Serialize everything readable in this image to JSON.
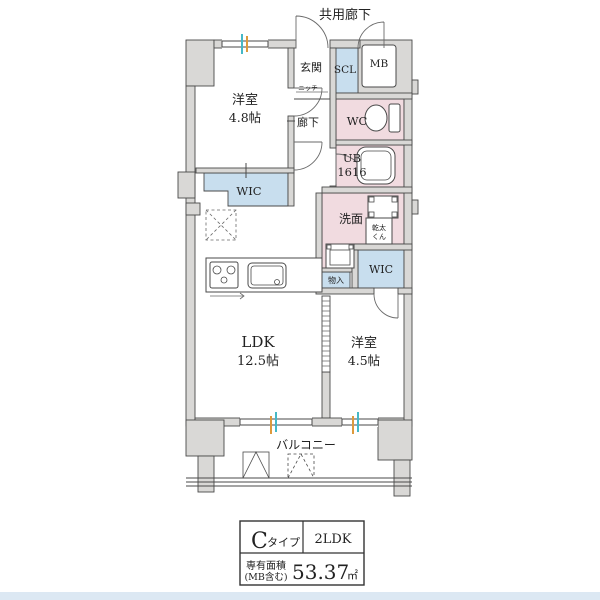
{
  "plan": {
    "common_corridor_label": "共用廊下",
    "entrance_label": "玄関",
    "niche_label": "ニッチ",
    "scl_label": "SCL",
    "mb_label": "MB",
    "wc_label": "WC",
    "hallway_label": "廊下",
    "bedroom1_name": "洋室",
    "bedroom1_size": "4.8帖",
    "wic_upper_label": "WIC",
    "bath_name": "UB",
    "bath_size": "1616",
    "washroom_label": "洗面",
    "dryer_line1": "乾太",
    "dryer_line2": "くん",
    "wic_lower_label": "WIC",
    "storage_label": "物入",
    "ldk_name": "LDK",
    "ldk_size": "12.5帖",
    "bedroom2_name": "洋室",
    "bedroom2_size": "4.5帖",
    "balcony_label": "バルコニー"
  },
  "info_table": {
    "type_letter": "C",
    "type_suffix": "タイプ",
    "layout": "2LDK",
    "area_label": "専有面積",
    "area_note": "(MB含む)",
    "area_value": "53.37",
    "area_unit": "㎡"
  },
  "colors": {
    "wall_fill": "#d9d8d6",
    "wet_area_pink": "#f1dbe0",
    "closet_blue": "#c8deee",
    "outline": "#4a4a4a",
    "footer_strip": "#dce8f3",
    "tick_teal": "#45b8c6",
    "tick_orange": "#dd9a3c"
  }
}
